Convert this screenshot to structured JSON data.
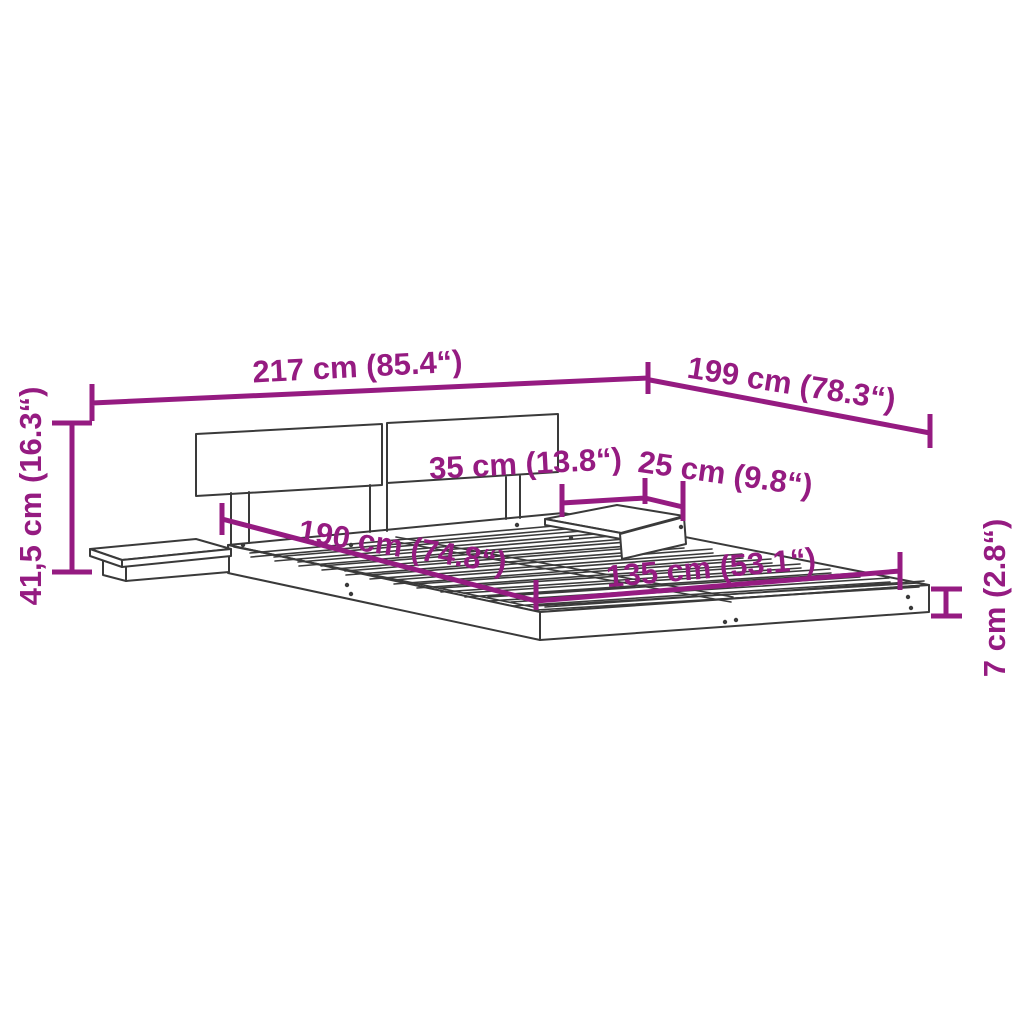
{
  "diagram": {
    "product": "platform bed frame with headboard and two floating nightstands",
    "background_color": "#ffffff",
    "drawing_color": "#3a3a3a",
    "dimension_color": "#951b81",
    "labels": {
      "total_width": "217 cm (85.4“)",
      "total_depth": "199 cm (78.3“)",
      "total_height": "41,5 cm (16.3“)",
      "nightstand_width": "35 cm (13.8“)",
      "nightstand_depth": "25 cm (9.8“)",
      "mattress_length": "190 cm (74.8“)",
      "mattress_width": "135 cm (53.1“)",
      "frame_height": "7 cm (2.8“)"
    }
  }
}
